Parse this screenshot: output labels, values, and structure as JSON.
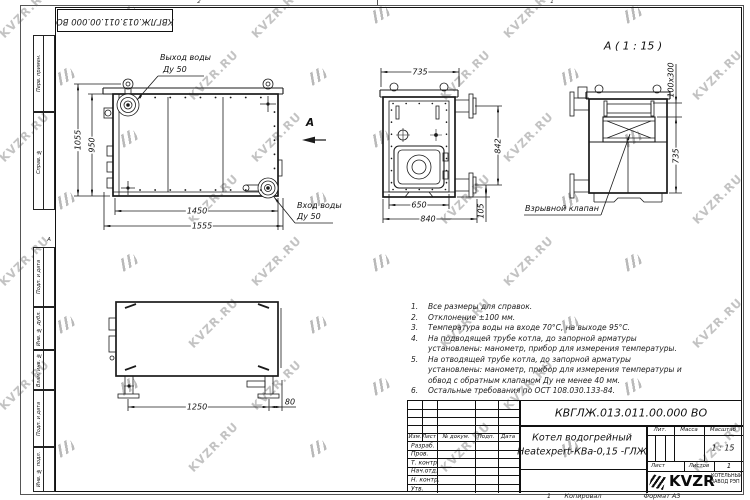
{
  "watermark": {
    "text": "KVZR.RU",
    "color": "#c3c3c3"
  },
  "frame": {
    "stamp": "КВГЛЖ.013.011.00.000 ВО",
    "side_labels": [
      "Перв. примен.",
      "Справ. №",
      "Подп. и дата",
      "Инв. № дубл.",
      "Взам. инв. №",
      "Подп. и дата",
      "Инв. № подл."
    ],
    "zone_top_left": "2",
    "zone_top_right": "1",
    "zone_left": "А",
    "zone_bottom": "1"
  },
  "drawing": {
    "front_view": {
      "callout_outlet": "Выход воды",
      "callout_outlet_dn": "Ду 50",
      "callout_inlet": "Вход воды",
      "callout_inlet_dn": "Ду 50",
      "view_arrow_label": "А",
      "dim_height_overall": "1055",
      "dim_height_body": "950",
      "dim_width_body": "1450",
      "dim_width_overall": "1555"
    },
    "side_view": {
      "dim_width_top": "735",
      "dim_height_pipes": "842",
      "dim_width_face": "650",
      "dim_width_overall": "840",
      "dim_pipe_offset": "105"
    },
    "section_view": {
      "title": "А ( 1 : 15 )",
      "callout_valve": "Взрывной клапан",
      "dim_opening": "100x300",
      "dim_height": "735"
    },
    "bottom_view": {
      "dim_span": "1250",
      "dim_offset": "80"
    }
  },
  "notes": [
    {
      "n": "1.",
      "t": "Все размеры для справок."
    },
    {
      "n": "2.",
      "t": "Отклонение ±100 мм."
    },
    {
      "n": "3.",
      "t": "Температура воды на входе 70°С, на выходе 95°С."
    },
    {
      "n": "4.",
      "t": "На подводящей трубе котла, до запорной арматуры установлены: манометр, прибор для измерения температуры."
    },
    {
      "n": "5.",
      "t": "На отводящей трубе котла, до запорной арматуры установлены: манометр, прибор для измерения температуры и обвод с обратным клапаном Ду не менее 40 мм."
    },
    {
      "n": "6.",
      "t": "Остальные требования по ОСТ 108.030.133-84."
    }
  ],
  "title_block": {
    "designation": "КВГЛЖ.013.011.00.000 ВО",
    "product_name_line1": "Котел водогрейный",
    "product_name_line2": "Heatexpert-КВа-0,15 -ГЛЖ",
    "col_izm": "Изм.",
    "col_list": "Лист",
    "col_doc": "№ докум.",
    "col_podp": "Подп.",
    "col_data": "Дата",
    "rows": [
      "Разраб.",
      "Пров.",
      "Т. контр.",
      "Нач.отд.",
      "Н. контр.",
      "Утв."
    ],
    "lit_label": "Лит.",
    "mass_label": "Масса",
    "scale_label": "Масштаб",
    "scale_value": "1 : 15",
    "sheet_label": "Лист",
    "sheets_label": "Листов",
    "sheets_value": "1",
    "brand": "KVZR",
    "company_line1": "КОТЕЛЬНЫЙ",
    "company_line2": "ЗАВОД РЭП",
    "footer_copied": "Копировал",
    "footer_format": "Формат А3"
  }
}
